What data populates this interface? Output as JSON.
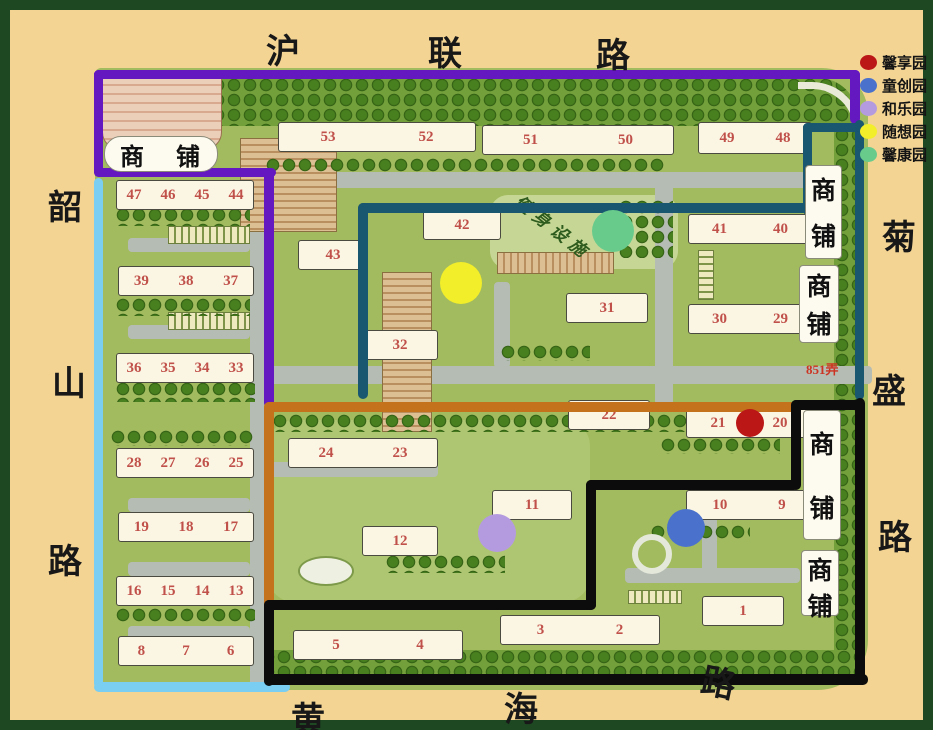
{
  "legend": {
    "items": [
      {
        "label": "馨享园",
        "color": "#bb1717"
      },
      {
        "label": "童创园",
        "color": "#4a72cc"
      },
      {
        "label": "和乐园",
        "color": "#b49be0"
      },
      {
        "label": "随想园",
        "color": "#f2ee2a"
      },
      {
        "label": "馨康园",
        "color": "#68cb8c"
      }
    ]
  },
  "roads": {
    "top": {
      "name": "沪联路",
      "chars": [
        {
          "ch": "沪",
          "x": 256,
          "y": 14
        },
        {
          "ch": "联",
          "x": 418,
          "y": 16
        },
        {
          "ch": "路",
          "x": 586,
          "y": 18
        }
      ]
    },
    "left": {
      "name": "韶山路",
      "chars": [
        {
          "ch": "韶",
          "x": 38,
          "y": 170
        },
        {
          "ch": "山",
          "x": 42,
          "y": 346
        },
        {
          "ch": "路",
          "x": 38,
          "y": 524
        }
      ]
    },
    "right": {
      "name": "菊盛路",
      "chars": [
        {
          "ch": "菊",
          "x": 872,
          "y": 200
        },
        {
          "ch": "盛",
          "x": 862,
          "y": 354
        },
        {
          "ch": "路",
          "x": 868,
          "y": 500
        }
      ]
    },
    "bottom": {
      "name": "黄海路",
      "chars": [
        {
          "ch": "黄",
          "x": 281,
          "y": 682
        },
        {
          "ch": "海",
          "x": 494,
          "y": 672
        },
        {
          "ch": "路",
          "x": 692,
          "y": 646,
          "rot": 12
        }
      ]
    }
  },
  "labels": {
    "shop": "商铺",
    "fitness": "健身设施",
    "lane": "851弄"
  },
  "map": {
    "buildings": [
      {
        "x": 268,
        "y": 112,
        "w": 196,
        "h": 28,
        "units": [
          "53",
          "52"
        ]
      },
      {
        "x": 472,
        "y": 115,
        "w": 190,
        "h": 28,
        "units": [
          "51",
          "50"
        ]
      },
      {
        "x": 688,
        "y": 112,
        "w": 112,
        "h": 30,
        "units": [
          "49",
          "48"
        ]
      },
      {
        "x": 106,
        "y": 170,
        "w": 136,
        "h": 28,
        "units": [
          "47",
          "46",
          "45",
          "44"
        ]
      },
      {
        "x": 108,
        "y": 256,
        "w": 134,
        "h": 28,
        "units": [
          "39",
          "38",
          "37"
        ]
      },
      {
        "x": 106,
        "y": 343,
        "w": 136,
        "h": 28,
        "units": [
          "36",
          "35",
          "34",
          "33"
        ]
      },
      {
        "x": 106,
        "y": 438,
        "w": 136,
        "h": 28,
        "units": [
          "28",
          "27",
          "26",
          "25"
        ]
      },
      {
        "x": 108,
        "y": 502,
        "w": 134,
        "h": 28,
        "units": [
          "19",
          "18",
          "17"
        ]
      },
      {
        "x": 106,
        "y": 566,
        "w": 136,
        "h": 28,
        "units": [
          "16",
          "15",
          "14",
          "13"
        ]
      },
      {
        "x": 108,
        "y": 626,
        "w": 134,
        "h": 28,
        "units": [
          "8",
          "7",
          "6"
        ]
      },
      {
        "x": 288,
        "y": 230,
        "w": 68,
        "h": 28,
        "units": [
          "43"
        ]
      },
      {
        "x": 413,
        "y": 200,
        "w": 76,
        "h": 28,
        "units": [
          "42"
        ]
      },
      {
        "x": 352,
        "y": 320,
        "w": 74,
        "h": 28,
        "units": [
          "32"
        ]
      },
      {
        "x": 556,
        "y": 283,
        "w": 80,
        "h": 28,
        "units": [
          "31"
        ]
      },
      {
        "x": 678,
        "y": 204,
        "w": 122,
        "h": 28,
        "units": [
          "41",
          "40"
        ]
      },
      {
        "x": 678,
        "y": 294,
        "w": 122,
        "h": 28,
        "units": [
          "30",
          "29"
        ]
      },
      {
        "x": 278,
        "y": 428,
        "w": 148,
        "h": 28,
        "units": [
          "24",
          "23"
        ]
      },
      {
        "x": 352,
        "y": 516,
        "w": 74,
        "h": 28,
        "units": [
          "12"
        ]
      },
      {
        "x": 558,
        "y": 390,
        "w": 80,
        "h": 28,
        "units": [
          "22"
        ]
      },
      {
        "x": 676,
        "y": 398,
        "w": 124,
        "h": 28,
        "units": [
          "21",
          "20"
        ]
      },
      {
        "x": 482,
        "y": 480,
        "w": 78,
        "h": 28,
        "units": [
          "11"
        ]
      },
      {
        "x": 676,
        "y": 480,
        "w": 124,
        "h": 28,
        "units": [
          "10",
          "9"
        ]
      },
      {
        "x": 283,
        "y": 620,
        "w": 168,
        "h": 28,
        "units": [
          "5",
          "4"
        ]
      },
      {
        "x": 490,
        "y": 605,
        "w": 158,
        "h": 28,
        "units": [
          "3",
          "2"
        ]
      },
      {
        "x": 692,
        "y": 586,
        "w": 80,
        "h": 28,
        "units": [
          "1"
        ]
      }
    ],
    "shops": [
      {
        "x": 94,
        "y": 126,
        "w": 112,
        "h": 34,
        "orientation": "horizontal"
      },
      {
        "x": 795,
        "y": 155,
        "w": 35,
        "h": 92,
        "orientation": "vertical"
      },
      {
        "x": 789,
        "y": 255,
        "w": 38,
        "h": 76,
        "orientation": "vertical"
      },
      {
        "x": 793,
        "y": 400,
        "w": 36,
        "h": 128,
        "orientation": "vertical"
      },
      {
        "x": 791,
        "y": 540,
        "w": 36,
        "h": 64,
        "orientation": "vertical"
      }
    ],
    "garden_dots": [
      {
        "garden": "馨享园",
        "color": "#bb1717",
        "x": 740,
        "y": 413,
        "r": 14
      },
      {
        "garden": "童创园",
        "color": "#4a72cc",
        "x": 676,
        "y": 518,
        "r": 19
      },
      {
        "garden": "和乐园",
        "color": "#b49be0",
        "x": 487,
        "y": 523,
        "r": 19
      },
      {
        "garden": "随想园",
        "color": "#f2ee2a",
        "x": 451,
        "y": 273,
        "r": 21
      },
      {
        "garden": "馨康园",
        "color": "#68cb8c",
        "x": 603,
        "y": 221,
        "r": 21
      }
    ],
    "boundaries": [
      {
        "line": "purple",
        "color": "#6318c0",
        "segments": [
          [
            84,
            60,
            766,
            9
          ],
          [
            84,
            60,
            9,
            106
          ],
          [
            84,
            158,
            182,
            9
          ],
          [
            254,
            158,
            10,
            240
          ],
          [
            840,
            60,
            10,
            54
          ]
        ]
      },
      {
        "line": "teal",
        "color": "#19566f",
        "segments": [
          [
            845,
            110,
            9,
            280
          ],
          [
            793,
            113,
            58,
            9
          ],
          [
            793,
            113,
            9,
            92
          ],
          [
            348,
            193,
            452,
            10
          ],
          [
            348,
            193,
            10,
            196
          ]
        ]
      },
      {
        "line": "cyan",
        "color": "#79cef2",
        "segments": [
          [
            84,
            168,
            9,
            510
          ],
          [
            84,
            672,
            196,
            10
          ]
        ]
      },
      {
        "line": "orange",
        "color": "#c4731c",
        "segments": [
          [
            254,
            392,
            532,
            10
          ],
          [
            254,
            392,
            10,
            206
          ]
        ]
      },
      {
        "line": "black",
        "color": "#0c0c0c",
        "segments": [
          [
            781,
            390,
            72,
            10
          ],
          [
            781,
            390,
            10,
            90
          ],
          [
            576,
            470,
            213,
            10
          ],
          [
            576,
            470,
            10,
            130
          ],
          [
            254,
            590,
            332,
            10
          ],
          [
            254,
            590,
            10,
            86
          ],
          [
            254,
            664,
            604,
            11
          ],
          [
            845,
            388,
            10,
            284
          ]
        ]
      }
    ]
  }
}
